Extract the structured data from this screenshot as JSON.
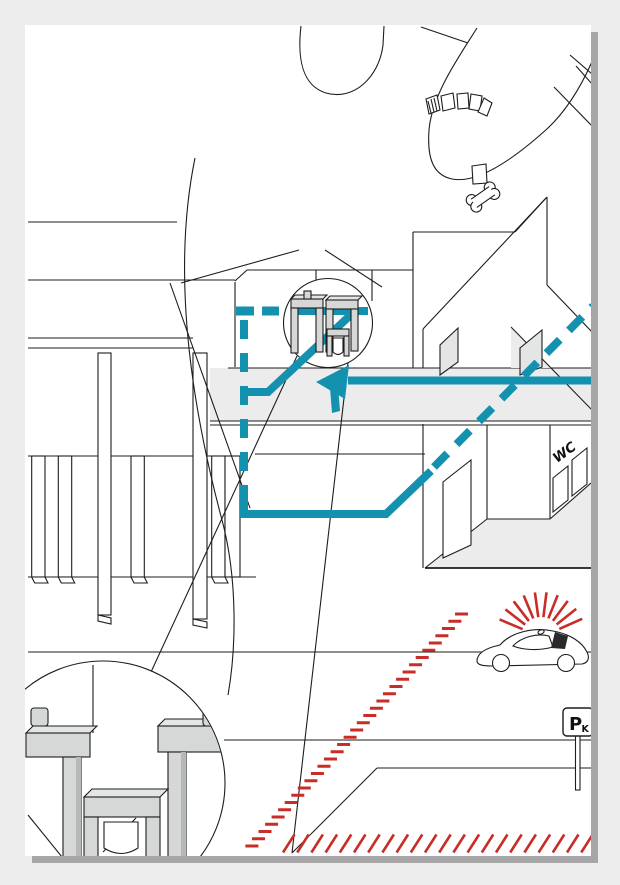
{
  "canvas": {
    "background": "#ededee",
    "paper": "#ffffff",
    "shadow": "#a6a6a6"
  },
  "artwork": {
    "line_color": "#1d1d1d",
    "route_color": "#1491af",
    "warning_color": "#c92d28",
    "surface_gray": "#ececec",
    "machine_gray": "#d6d8d8"
  },
  "labels": {
    "wc_sign": "WC",
    "parking_sign_main": "P",
    "parking_sign_sub": "K"
  }
}
